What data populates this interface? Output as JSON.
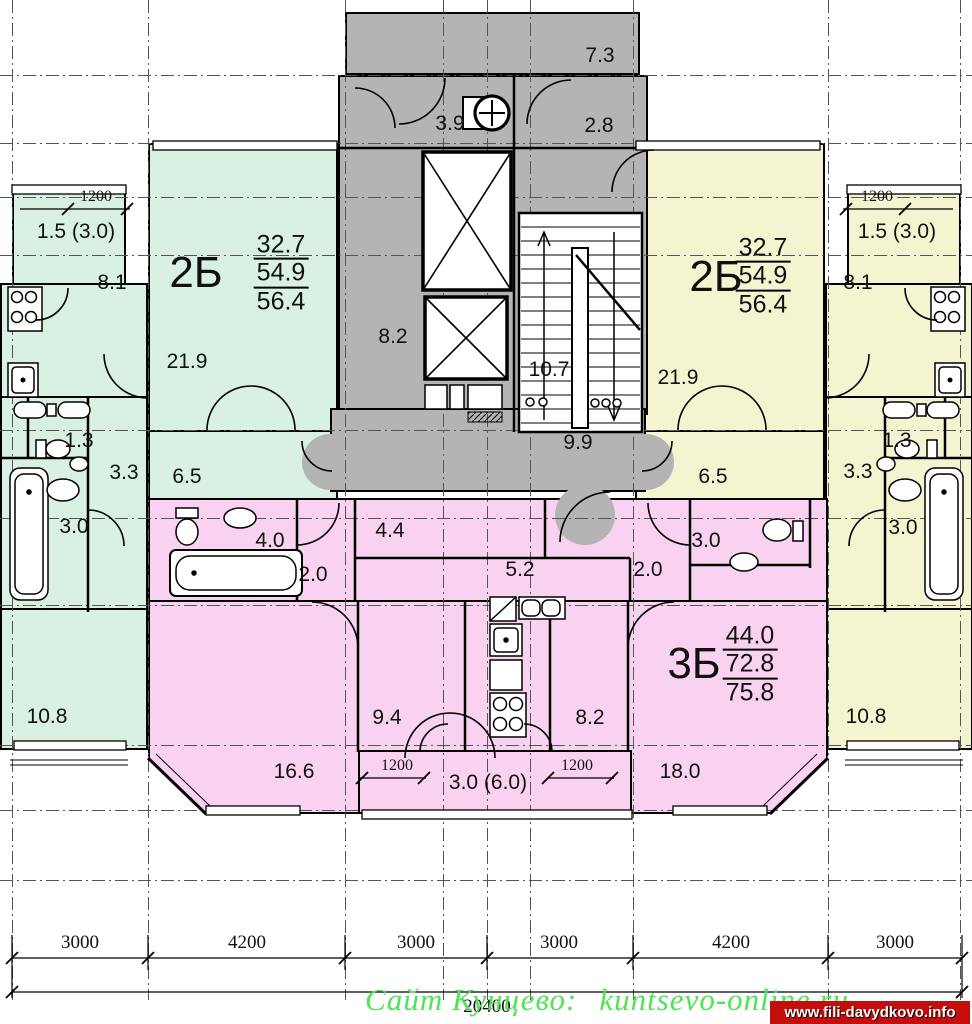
{
  "core": {
    "vent_room_area": "7.3",
    "chute_room_area": "3.9",
    "vestibule_area": "2.8",
    "lift_hall_area": "8.2",
    "stair_area": "10.7",
    "corridor_area": "9.9"
  },
  "apartment_left": {
    "type_label": "2Б",
    "living_area": "32.7",
    "usable_area": "54.9",
    "total_area": "56.4",
    "balcony_area": "1.5 (3.0)",
    "balcony_dim": "1200",
    "kitchen_area": "8.1",
    "living_room_area": "21.9",
    "wc_area": "1.3",
    "hall_area": "3.3",
    "corridor_area": "6.5",
    "bath_area": "3.0",
    "bedroom_area": "10.8"
  },
  "apartment_right": {
    "type_label": "2Б",
    "living_area": "32.7",
    "usable_area": "54.9",
    "total_area": "56.4",
    "balcony_area": "1.5 (3.0)",
    "balcony_dim": "1200",
    "kitchen_area": "8.1",
    "living_room_area": "21.9",
    "wc_area": "1.3",
    "hall_area": "3.3",
    "corridor_area": "6.5",
    "bath_area": "3.0",
    "bedroom_area": "10.8"
  },
  "apartment_bottom": {
    "type_label": "3Б",
    "living_area": "44.0",
    "usable_area": "72.8",
    "total_area": "75.8",
    "bath_area": "4.0",
    "hall_left_area": "2.0",
    "corridor_area": "4.4",
    "hall_center_area": "5.2",
    "hall_right_area": "2.0",
    "wc_area": "3.0",
    "room_left_area": "16.6",
    "kitchen_area": "9.4",
    "room_center_area": "8.2",
    "room_right_area": "18.0",
    "balcony_area": "3.0 (6.0)",
    "balcony_dim_left": "1200",
    "balcony_dim_right": "1200"
  },
  "dimensions": {
    "segments": [
      "3000",
      "4200",
      "3000",
      "3000",
      "4200",
      "3000"
    ],
    "total": "20400"
  },
  "watermark": {
    "site": "Сайт Кунцево:",
    "url": "kuntsevo-online.ru",
    "badge": "www.fili-davydkovo.info"
  },
  "colors": {
    "apartment_left": "#d8f1e3",
    "apartment_right": "#f4f5d0",
    "apartment_bottom": "#f8d2f0",
    "core": "#b4b4b4",
    "watermark_green": "#4fe455",
    "badge_red": "#c40d0d"
  }
}
